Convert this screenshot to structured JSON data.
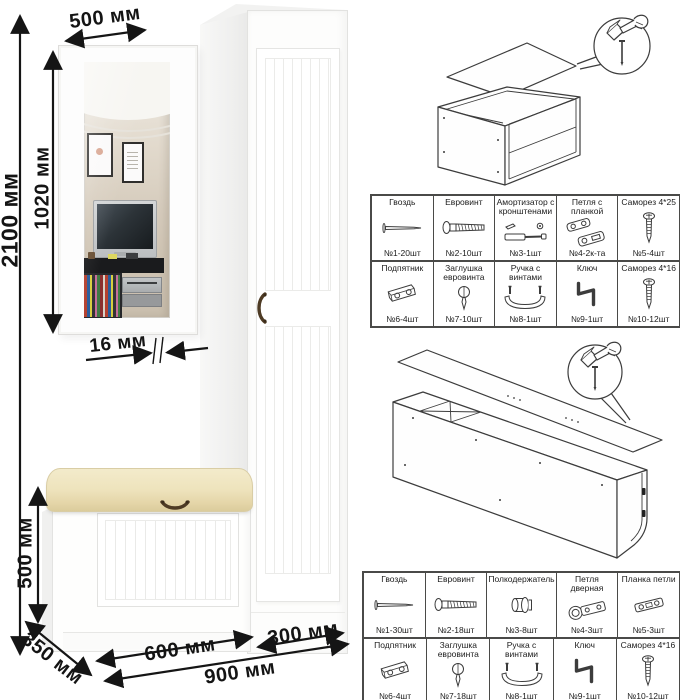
{
  "scene": {
    "dimensions": {
      "total_height": "2100 мм",
      "mirror_width": "500 мм",
      "mirror_height": "1020 мм",
      "mirror_thickness": "16 мм",
      "bench_height": "500 мм",
      "bench_depth": "350 мм",
      "bench_width": "600 мм",
      "wardrobe_width": "300 мм",
      "total_width": "900 мм"
    }
  },
  "hardware_tables": [
    {
      "id": "mirror-bench-hardware",
      "rows": [
        [
          {
            "name": "Гвоздь",
            "qty": "№1-20шт",
            "icon": "nail-icon"
          },
          {
            "name": "Евровинт",
            "qty": "№2-10шт",
            "icon": "confirmat-screw-icon"
          },
          {
            "name": "Амортизатор с кронштенами",
            "qty": "№3-1шт",
            "icon": "gas-strut-icon"
          },
          {
            "name": "Петля с планкой",
            "qty": "№4-2к-та",
            "icon": "hinge-with-plate-icon"
          },
          {
            "name": "Саморез 4*25",
            "qty": "№5-4шт",
            "icon": "screw-icon"
          }
        ],
        [
          {
            "name": "Подпятник",
            "qty": "№6-4шт",
            "icon": "footpad-icon"
          },
          {
            "name": "Заглушка евровинта",
            "qty": "№7-10шт",
            "icon": "cap-icon"
          },
          {
            "name": "Ручка с винтами",
            "qty": "№8-1шт",
            "icon": "handle-icon"
          },
          {
            "name": "Ключ",
            "qty": "№9-1шт",
            "icon": "key-icon"
          },
          {
            "name": "Саморез 4*16",
            "qty": "№10-12шт",
            "icon": "screw-icon"
          }
        ]
      ]
    },
    {
      "id": "wardrobe-hardware",
      "rows": [
        [
          {
            "name": "Гвоздь",
            "qty": "№1-30шт",
            "icon": "nail-icon"
          },
          {
            "name": "Евровинт",
            "qty": "№2-18шт",
            "icon": "confirmat-screw-icon"
          },
          {
            "name": "Полкодержатель",
            "qty": "№3-8шт",
            "icon": "shelf-pin-icon"
          },
          {
            "name": "Петля дверная",
            "qty": "№4-3шт",
            "icon": "door-hinge-icon"
          },
          {
            "name": "Планка петли",
            "qty": "№5-3шт",
            "icon": "hinge-plate-icon"
          }
        ],
        [
          {
            "name": "Подпятник",
            "qty": "№6-4шт",
            "icon": "footpad-icon"
          },
          {
            "name": "Заглушка евровинта",
            "qty": "№7-18шт",
            "icon": "cap-icon"
          },
          {
            "name": "Ручка с винтами",
            "qty": "№8-1шт",
            "icon": "handle-icon"
          },
          {
            "name": "Ключ",
            "qty": "№9-1шт",
            "icon": "key-icon"
          },
          {
            "name": "Саморез 4*16",
            "qty": "№10-12шт",
            "icon": "screw-icon"
          }
        ]
      ]
    }
  ],
  "colors": {
    "background": "#ffffff",
    "dimension_text": "#141414",
    "cushion": "#eee3bc",
    "handle_bronze": "#4e3b24",
    "furniture_white": "#fdfdfc",
    "table_border": "#4a4a48"
  }
}
